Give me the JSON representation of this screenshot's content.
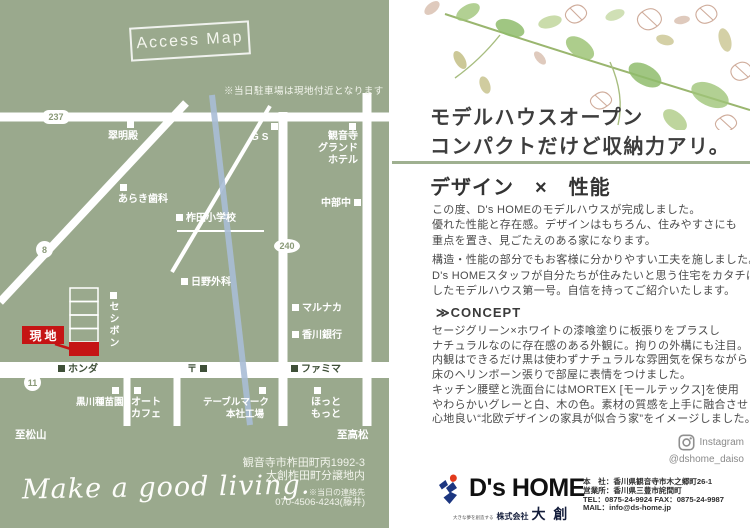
{
  "colors": {
    "page_green": "#9aa98d",
    "accent_green": "#9fb090",
    "site_red": "#c51414",
    "river_blue": "#a9bdd6",
    "logo_red": "#e23a1c",
    "logo_blue": "#1c3680"
  },
  "map": {
    "title": "Access Map",
    "parking_note": "※当日駐車場は現地付近となります",
    "site_label": "現地",
    "badges": {
      "r237": "237",
      "r8": "8",
      "r240": "240",
      "r11": "11"
    },
    "pois": {
      "suimeiden": "翠明殿",
      "araki": "あらき歯科",
      "gs": "GS",
      "hotel": [
        "観音寺",
        "グランド",
        "ホテル"
      ],
      "school": "柞田小学校",
      "chubu": "中部中",
      "hino": "日野外科",
      "marunaka": "マルナカ",
      "kagawa_bank": "香川銀行",
      "seshibon": "セシボン",
      "honda": "ホンダ",
      "post_mark": "〒",
      "famima": "ファミマ",
      "kurokawa": "黒川種苗園",
      "auto_cafe": [
        "オート",
        "カフェ"
      ],
      "tablemark": [
        "テーブルマーク",
        "本社工場"
      ],
      "hotto": [
        "ほっと",
        "もっと"
      ]
    },
    "directions": {
      "matsuyama": "至松山",
      "takamatsu": "至高松"
    },
    "address": [
      "観音寺市柞田町丙1992-3",
      "大創柞田町分譲地内"
    ],
    "contact_note": "※当日の連絡先",
    "contact_phone": "070-4506-4243(藤井)",
    "tagline": "Make a good living."
  },
  "flyer": {
    "headline": [
      "モデルハウスオープン",
      "コンパクトだけど収納力アリ。"
    ],
    "section_title": "デザイン　×　性能",
    "intro1": [
      "この度、D's HOMEのモデルハウスが完成しました。",
      "優れた性能と存在感。デザインはもちろん、住みやすさにも",
      "重点を置き、見ごたえのある家になります。"
    ],
    "intro2": [
      "構造・性能の部分でもお客様に分かりやすい工夫を施しました。"
    ],
    "intro3": [
      "D's HOMEスタッフが自分たちが住みたいと思う住宅をカタチに",
      "したモデルハウス第一号。自信を持ってご紹介いたします。"
    ],
    "concept_title": "≫CONCEPT",
    "concept1": [
      "セージグリーン×ホワイトの漆喰塗りに板張りをプラスし",
      "ナチュラルなのに存在感のある外観に。拘りの外構にも注目。",
      "内観はできるだけ黒は使わずナチュラルな雰囲気を保ちながら",
      "床のヘリンボーン張りで部屋に表情をつけました。"
    ],
    "concept2": [
      "キッチン腰壁と洗面台にはMORTEX [モールテックス]を使用",
      "やわらかいグレーと白、木の色。素材の質感を上手に融合させ",
      "心地良い“北欧デザインの家具が似合う家”をイメージしました。"
    ],
    "instagram": {
      "label": "Instagram",
      "handle": "@dshome_daiso"
    },
    "logo": {
      "name": "D's HOME",
      "tagline": "大きな夢を創造する",
      "company_prefix": "株式会社",
      "company_name": "大 創"
    },
    "company_info": [
      "本　社：香川県観音寺市木之郷町26-1",
      "営業所：香川県三豊市詫間町",
      "TEL：0875-24-9924 FAX：0875-24-9987",
      "MAIL：info@ds-home.jp"
    ]
  }
}
